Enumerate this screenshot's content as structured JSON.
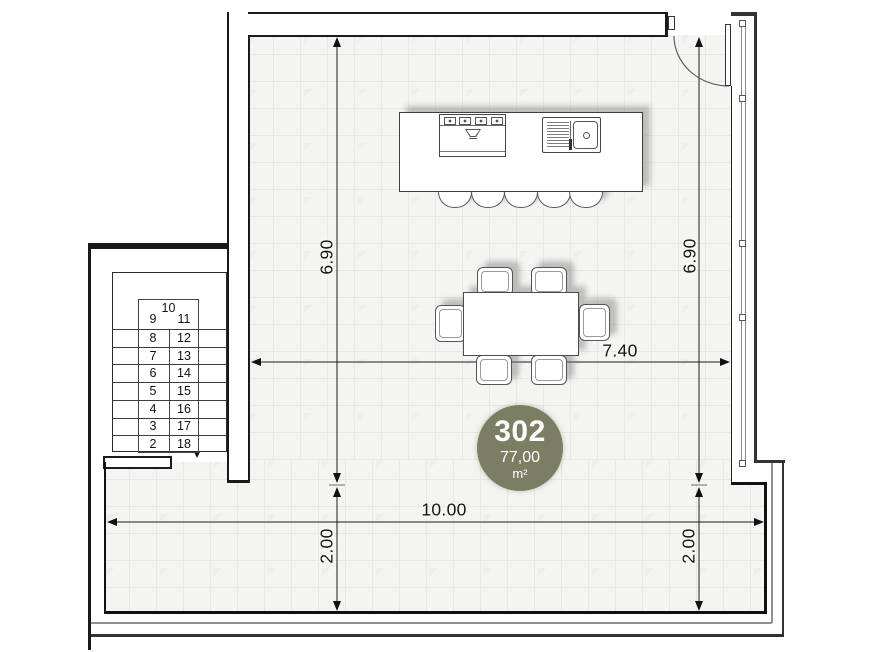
{
  "plan": {
    "badge": {
      "number": "302",
      "area": "77,00",
      "area_unit": "m²",
      "bg_color": "#7b7e62",
      "text_color": "#ffffff"
    },
    "dimensions": {
      "room_height_left": "6.90",
      "room_height_right": "6.90",
      "room_width": "7.40",
      "terrace_width": "10.00",
      "terrace_depth_left": "2.00",
      "terrace_depth_right": "2.00"
    },
    "stairs": {
      "top_number": "10",
      "left_numbers": [
        "9",
        "8",
        "7",
        "6",
        "5",
        "4",
        "3",
        "2"
      ],
      "right_numbers": [
        "11",
        "12",
        "13",
        "14",
        "15",
        "16",
        "17",
        "18"
      ]
    },
    "colors": {
      "wall": "#1a1a1a",
      "floor": "#f4f4f2",
      "floor_grid": "#e7e7e4",
      "dimension_line": "#1c1c1c"
    }
  }
}
